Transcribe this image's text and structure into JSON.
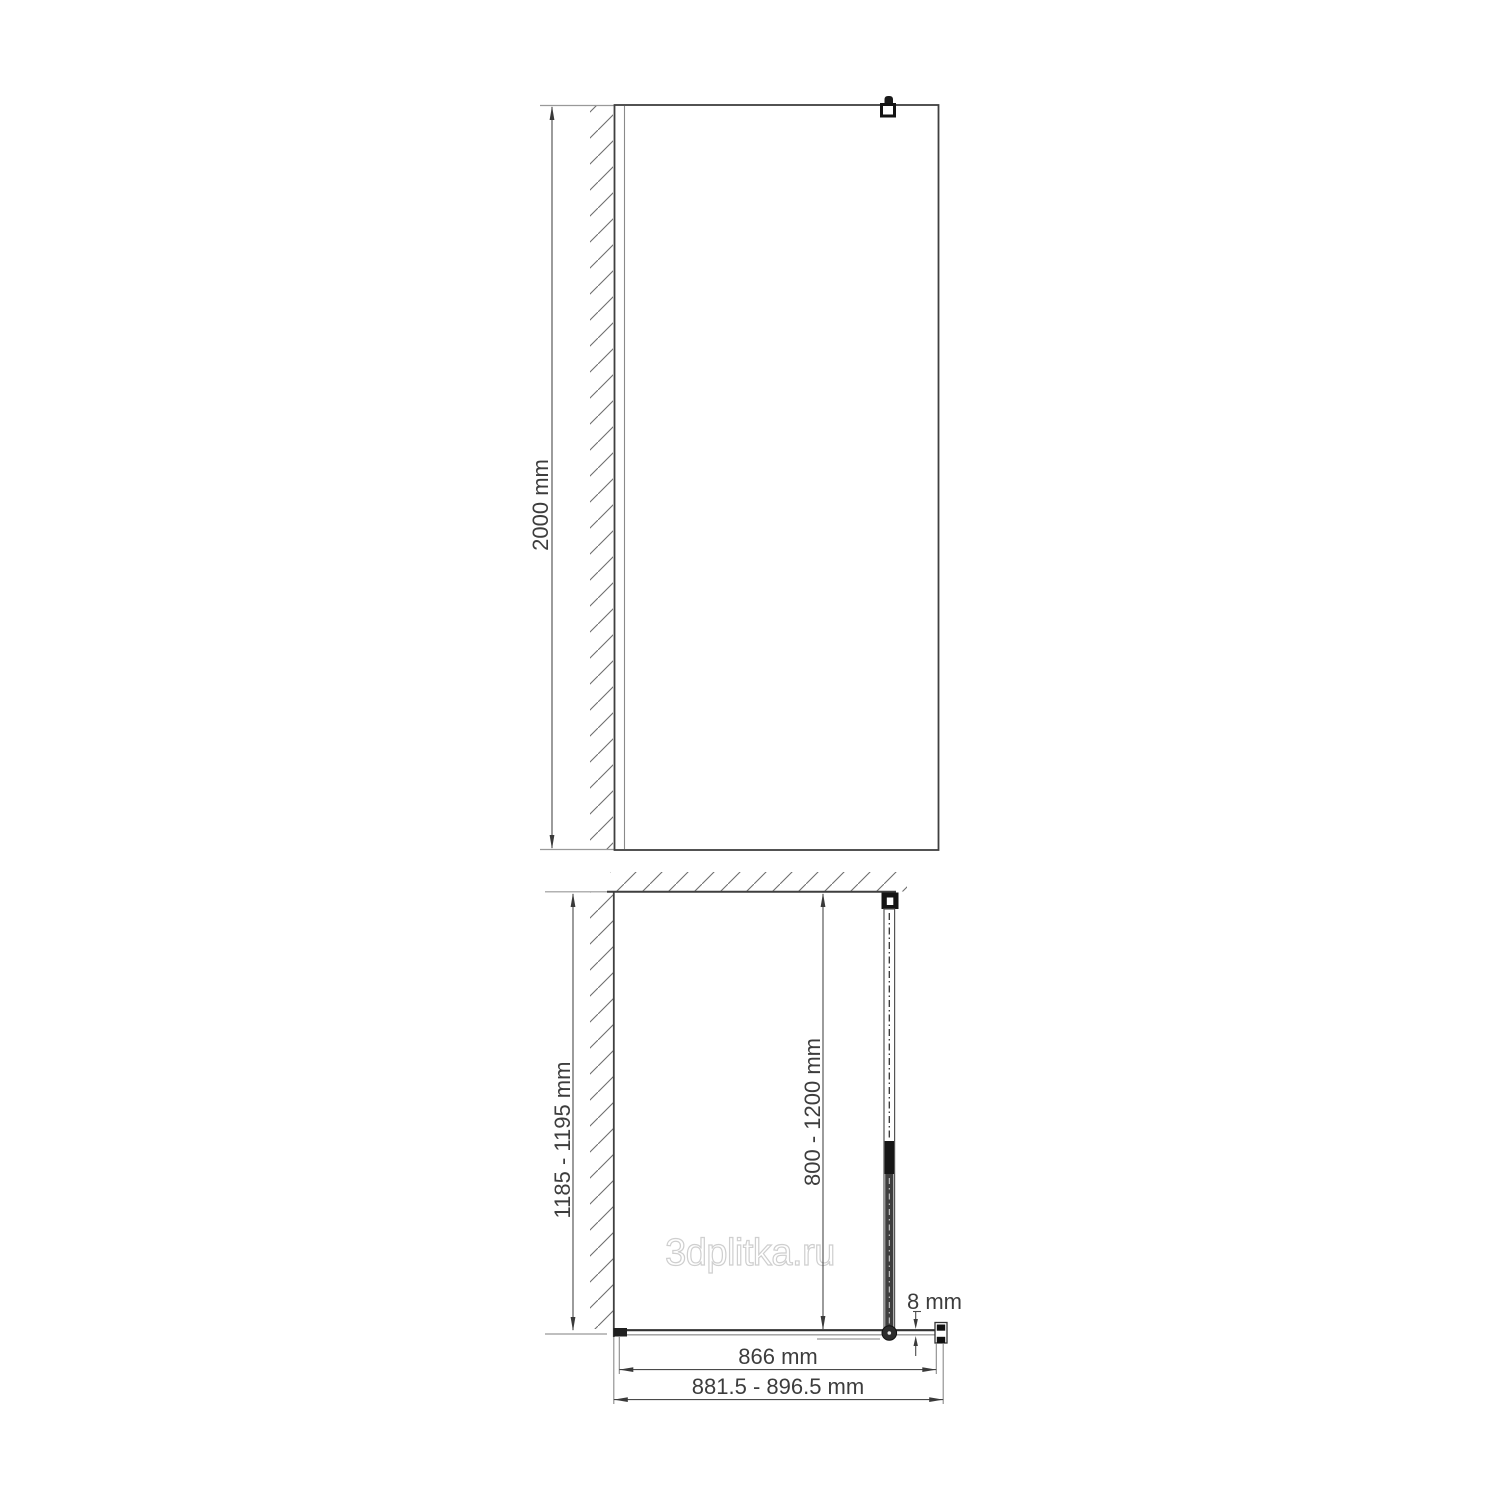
{
  "diagram": {
    "watermark": "3dplitka.ru",
    "front_view": {
      "height_label": "2000 mm"
    },
    "top_view": {
      "depth_label": "1185 - 1195 mm",
      "support_bar_label": "800 - 1200 mm",
      "glass_thickness_label": "8 mm",
      "glass_width_label": "866 mm",
      "overall_width_label": "881.5 - 896.5 mm"
    },
    "colors": {
      "line": "#3d3d3d",
      "extension_line": "#999999",
      "watermark_outline": "#cfcfcf",
      "background": "#ffffff"
    }
  }
}
